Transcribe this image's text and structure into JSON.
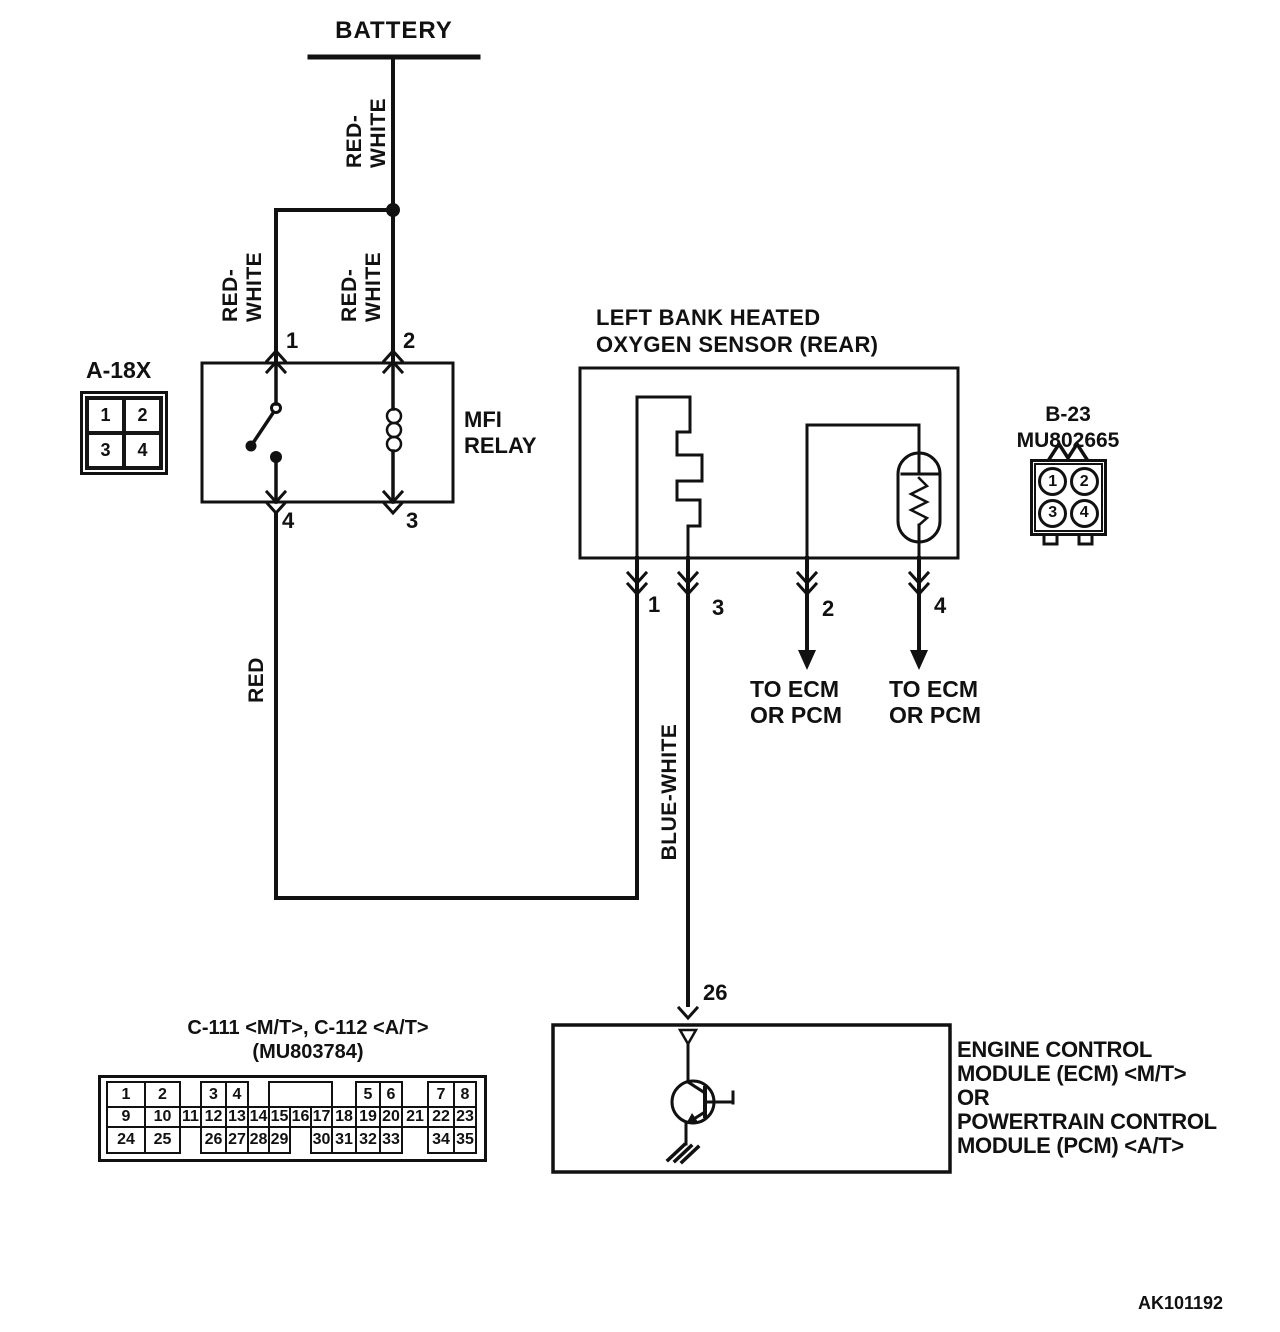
{
  "battery": {
    "label": "BATTERY"
  },
  "wires": {
    "battery_feed": [
      "RED-",
      "WHITE"
    ],
    "relay_branch_left": [
      "RED-",
      "WHITE"
    ],
    "relay_branch_right": [
      "RED-",
      "WHITE"
    ],
    "heater_power": "RED",
    "heater_ground": "BLUE-WHITE"
  },
  "mfi_relay": {
    "label_lines": [
      "MFI",
      "RELAY"
    ],
    "pin_top_left": "1",
    "pin_top_right": "2",
    "pin_bottom_left": "4",
    "pin_bottom_right": "3"
  },
  "connector_a18x": {
    "title": "A-18X",
    "pins": [
      "1",
      "2",
      "3",
      "4"
    ]
  },
  "oxygen_sensor": {
    "title_lines": [
      "LEFT BANK HEATED",
      "OXYGEN SENSOR (REAR)"
    ],
    "pin_1": "1",
    "pin_3": "3",
    "pin_2": "2",
    "pin_4": "4"
  },
  "connector_b23": {
    "title_lines": [
      "B-23",
      "MU802665"
    ],
    "pins": [
      "1",
      "2",
      "3",
      "4"
    ]
  },
  "to_ecm_left": {
    "line1": "TO ECM",
    "line2": "OR PCM"
  },
  "to_ecm_right": {
    "line1": "TO ECM",
    "line2": "OR PCM"
  },
  "ecm": {
    "pin": "26",
    "label_lines": [
      "ENGINE CONTROL",
      "MODULE (ECM) <M/T>",
      "OR",
      "POWERTRAIN CONTROL",
      "MODULE (PCM) <A/T>"
    ]
  },
  "connector_c111": {
    "title": "C-111 <M/T>, C-112 <A/T>",
    "subtitle": "(MU803784)",
    "col_widths": [
      38,
      35,
      21,
      25,
      22,
      21,
      21,
      21,
      21,
      24,
      24,
      22,
      26,
      26,
      22
    ],
    "rows": [
      {
        "cells": [
          {
            "label": "1",
            "col": 1
          },
          {
            "label": "2",
            "col": 2
          },
          {
            "label": "3",
            "col": 4
          },
          {
            "label": "4",
            "col": 5
          },
          {
            "label": "",
            "col": 7,
            "span": 3
          },
          {
            "label": "5",
            "col": 11
          },
          {
            "label": "6",
            "col": 12
          },
          {
            "label": "7",
            "col": 14
          },
          {
            "label": "8",
            "col": 15
          }
        ]
      },
      {
        "cells": [
          {
            "label": "9",
            "col": 1
          },
          {
            "label": "10",
            "col": 2
          },
          {
            "label": "11",
            "col": 3
          },
          {
            "label": "12",
            "col": 4
          },
          {
            "label": "13",
            "col": 5
          },
          {
            "label": "14",
            "col": 6
          },
          {
            "label": "15",
            "col": 7
          },
          {
            "label": "16",
            "col": 8
          },
          {
            "label": "17",
            "col": 9
          },
          {
            "label": "18",
            "col": 10
          },
          {
            "label": "19",
            "col": 11
          },
          {
            "label": "20",
            "col": 12
          },
          {
            "label": "21",
            "col": 13
          },
          {
            "label": "22",
            "col": 14
          },
          {
            "label": "23",
            "col": 15
          }
        ]
      },
      {
        "cells": [
          {
            "label": "24",
            "col": 1
          },
          {
            "label": "25",
            "col": 2
          },
          {
            "label": "26",
            "col": 4
          },
          {
            "label": "27",
            "col": 5
          },
          {
            "label": "28",
            "col": 6
          },
          {
            "label": "29",
            "col": 7
          },
          {
            "label": "30",
            "col": 9
          },
          {
            "label": "31",
            "col": 10
          },
          {
            "label": "32",
            "col": 11
          },
          {
            "label": "33",
            "col": 12
          },
          {
            "label": "34",
            "col": 14
          },
          {
            "label": "35",
            "col": 15
          }
        ]
      }
    ]
  },
  "figure_code": "AK101192",
  "colors": {
    "ink": "#111111",
    "paper": "#ffffff"
  }
}
